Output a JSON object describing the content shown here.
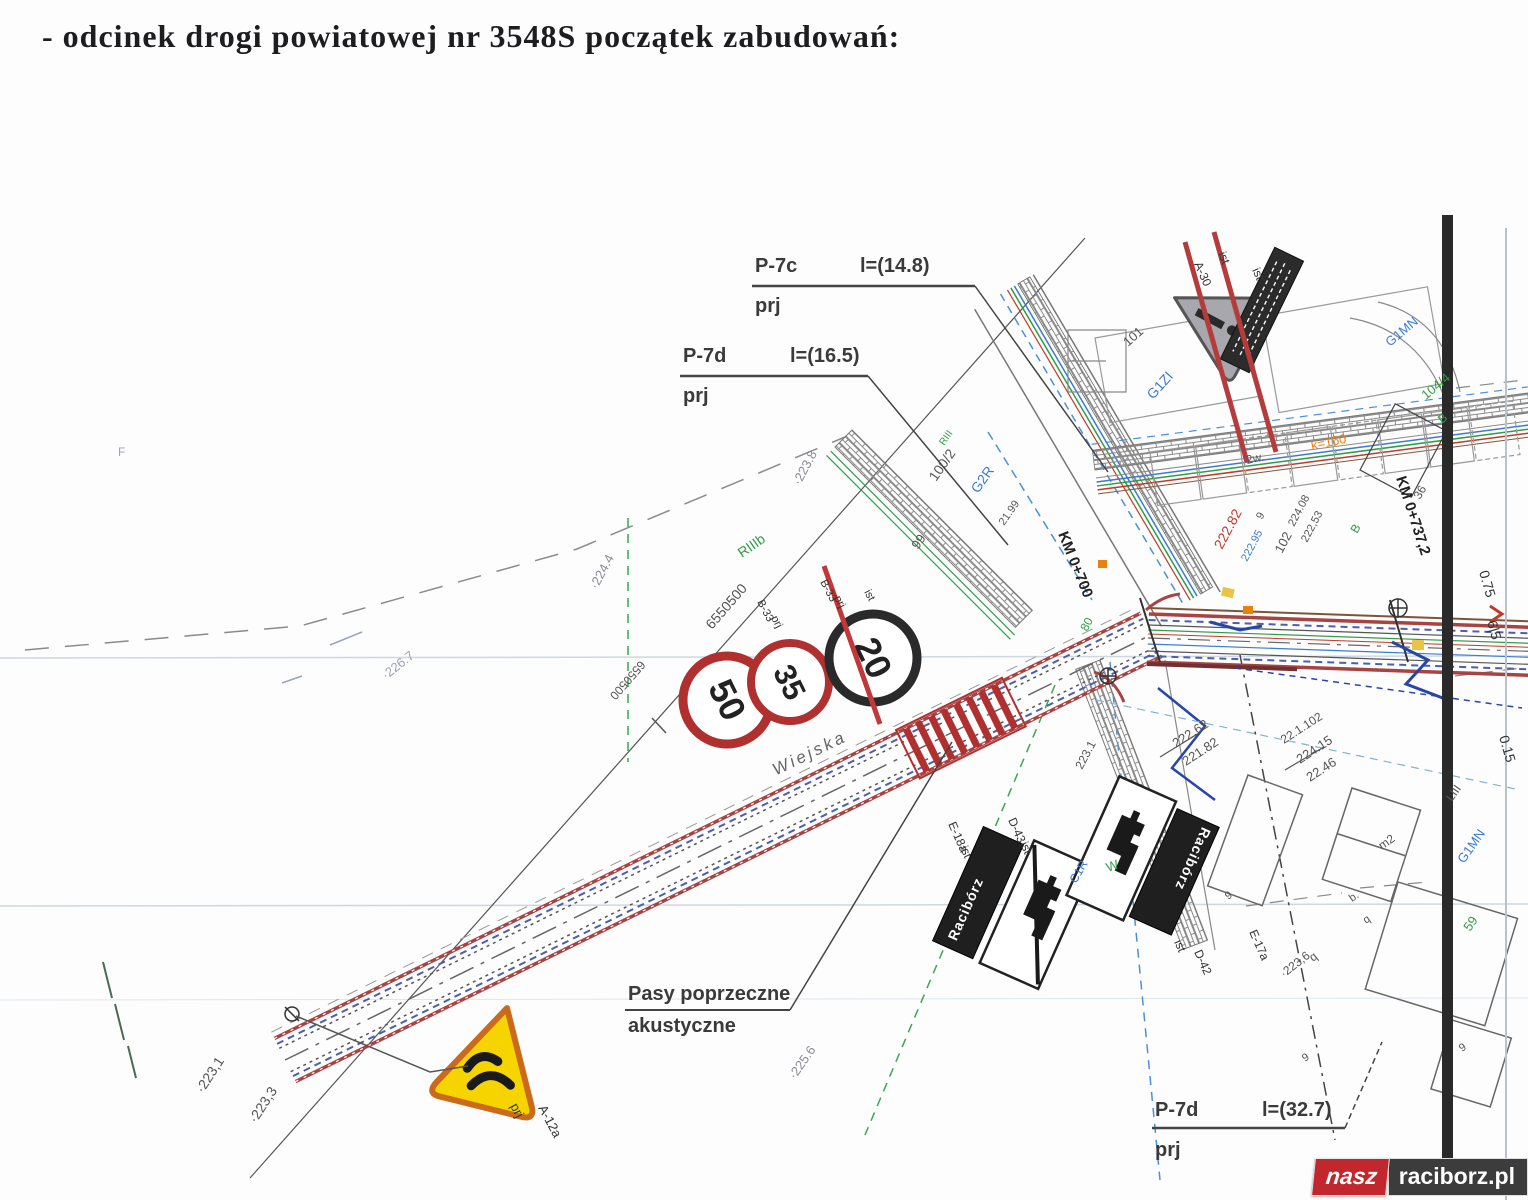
{
  "page": {
    "heading": "- odcinek drogi powiatowej nr 3548S początek zabudowań:"
  },
  "callouts": {
    "p7c": {
      "code": "P-7c",
      "length": "l=(14.8)",
      "status": "prj"
    },
    "p7d_top": {
      "code": "P-7d",
      "length": "l=(16.5)",
      "status": "prj"
    },
    "p7d_bottom": {
      "code": "P-7d",
      "length": "l=(32.7)",
      "status": "prj"
    },
    "acoustic": {
      "line1": "Pasy poprzeczne",
      "line2": "akustyczne"
    }
  },
  "signs": {
    "speed50": {
      "value": "50"
    },
    "speed35": {
      "value": "35"
    },
    "speed20": {
      "value": "20"
    },
    "town_name_left": "Racibórz",
    "town_name_right": "Racibórz"
  },
  "map": {
    "street_name": "Wiejska",
    "labels": [
      {
        "t": "·223.8",
        "x": 800,
        "y": 486,
        "r": -62,
        "c": "#8b8b95",
        "s": 13
      },
      {
        "t": "·224.4",
        "x": 597,
        "y": 590,
        "r": -62,
        "c": "#8b8b95",
        "s": 13
      },
      {
        "t": "·226.7",
        "x": 386,
        "y": 680,
        "r": -38,
        "c": "#9aa4b5",
        "s": 13
      },
      {
        "t": "·225.6",
        "x": 795,
        "y": 1080,
        "r": -55,
        "c": "#8b8b95",
        "s": 13
      },
      {
        "t": "·223,1",
        "x": 203,
        "y": 1094,
        "r": -57,
        "c": "#555555",
        "s": 14
      },
      {
        "t": "·223,3",
        "x": 256,
        "y": 1124,
        "r": -57,
        "c": "#555555",
        "s": 14
      },
      {
        "t": "6550500",
        "x": 712,
        "y": 630,
        "r": -49,
        "c": "#555555",
        "s": 14
      },
      {
        "t": "6550500",
        "x": 640,
        "y": 660,
        "r": 131,
        "c": "#555555",
        "s": 12
      },
      {
        "t": "RIIIb",
        "x": 742,
        "y": 558,
        "r": -35,
        "c": "#2f9e44",
        "s": 14
      },
      {
        "t": "RIII",
        "x": 944,
        "y": 446,
        "r": -55,
        "c": "#2f9e44",
        "s": 10
      },
      {
        "t": "100/2",
        "x": 936,
        "y": 482,
        "r": -55,
        "c": "#555555",
        "s": 14
      },
      {
        "t": "G2R",
        "x": 978,
        "y": 494,
        "r": -55,
        "c": "#3a7bd5",
        "s": 14
      },
      {
        "t": "21.99",
        "x": 1004,
        "y": 526,
        "r": -55,
        "c": "#555555",
        "s": 11
      },
      {
        "t": "99",
        "x": 918,
        "y": 550,
        "r": -55,
        "c": "#555555",
        "s": 13
      },
      {
        "t": "KM 0+700",
        "x": 1058,
        "y": 534,
        "r": 68,
        "c": "#222222",
        "s": 15,
        "b": 1
      },
      {
        "t": "KM 0+737,2",
        "x": 1396,
        "y": 478,
        "r": 72,
        "c": "#222222",
        "s": 15,
        "b": 1
      },
      {
        "t": "101",
        "x": 1128,
        "y": 347,
        "r": -42,
        "c": "#555555",
        "s": 13
      },
      {
        "t": "G1ZI",
        "x": 1153,
        "y": 400,
        "r": -48,
        "c": "#3a7bd5",
        "s": 14
      },
      {
        "t": "G1MN",
        "x": 1390,
        "y": 347,
        "r": -40,
        "c": "#3a7bd5",
        "s": 13
      },
      {
        "t": "104/4",
        "x": 1426,
        "y": 400,
        "r": -40,
        "c": "#2f9e44",
        "s": 13
      },
      {
        "t": "B",
        "x": 1442,
        "y": 424,
        "r": -40,
        "c": "#2f9e44",
        "s": 12
      },
      {
        "t": "B",
        "x": 1357,
        "y": 534,
        "r": -60,
        "c": "#2f9e44",
        "s": 12
      },
      {
        "t": "36",
        "x": 1420,
        "y": 500,
        "r": -60,
        "c": "#555555",
        "s": 12
      },
      {
        "t": "222.82",
        "x": 1222,
        "y": 550,
        "r": -62,
        "c": "#c0392b",
        "s": 14
      },
      {
        "t": "224.08",
        "x": 1294,
        "y": 527,
        "r": -62,
        "c": "#555555",
        "s": 11
      },
      {
        "t": "222,53",
        "x": 1307,
        "y": 543,
        "r": -62,
        "c": "#555555",
        "s": 11
      },
      {
        "t": "102",
        "x": 1282,
        "y": 554,
        "r": -62,
        "c": "#555555",
        "s": 13
      },
      {
        "t": "222.95",
        "x": 1247,
        "y": 562,
        "r": -62,
        "c": "#3a7bd5",
        "s": 11
      },
      {
        "t": "9",
        "x": 1262,
        "y": 520,
        "r": -62,
        "c": "#555555",
        "s": 11
      },
      {
        "t": "222.62",
        "x": 1176,
        "y": 748,
        "r": -33,
        "c": "#555555",
        "s": 13
      },
      {
        "t": "221.82",
        "x": 1186,
        "y": 766,
        "r": -33,
        "c": "#555555",
        "s": 13
      },
      {
        "t": "22.1.102",
        "x": 1284,
        "y": 744,
        "r": -33,
        "c": "#555555",
        "s": 12
      },
      {
        "t": "224.15",
        "x": 1300,
        "y": 764,
        "r": -33,
        "c": "#555555",
        "s": 13
      },
      {
        "t": "22.46",
        "x": 1310,
        "y": 782,
        "r": -33,
        "c": "#555555",
        "s": 13
      },
      {
        "t": "223.1",
        "x": 1082,
        "y": 770,
        "r": -62,
        "c": "#555555",
        "s": 12
      },
      {
        "t": "·223,6",
        "x": 1284,
        "y": 978,
        "r": -38,
        "c": "#555555",
        "s": 12
      },
      {
        "t": "q",
        "x": 1313,
        "y": 962,
        "r": -38,
        "c": "#555555",
        "s": 12
      },
      {
        "t": "b.",
        "x": 1352,
        "y": 902,
        "r": -35,
        "c": "#555555",
        "s": 11
      },
      {
        "t": "q",
        "x": 1366,
        "y": 924,
        "r": -35,
        "c": "#555555",
        "s": 11
      },
      {
        "t": "9",
        "x": 1228,
        "y": 900,
        "r": -35,
        "c": "#555555",
        "s": 11
      },
      {
        "t": "9",
        "x": 1305,
        "y": 1062,
        "r": -35,
        "c": "#555555",
        "s": 11
      },
      {
        "t": "9",
        "x": 1462,
        "y": 1052,
        "r": -35,
        "c": "#555555",
        "s": 11
      },
      {
        "t": "m2",
        "x": 1382,
        "y": 850,
        "r": -35,
        "c": "#555555",
        "s": 12
      },
      {
        "t": "2w.",
        "x": 1247,
        "y": 464,
        "r": -12,
        "c": "#555555",
        "s": 12
      },
      {
        "t": "k=160",
        "x": 1312,
        "y": 450,
        "r": -12,
        "c": "#e8820c",
        "s": 13
      },
      {
        "t": "0.75",
        "x": 1479,
        "y": 572,
        "r": 74,
        "c": "#333333",
        "s": 14
      },
      {
        "t": "6|5",
        "x": 1487,
        "y": 622,
        "r": 74,
        "c": "#333333",
        "s": 14
      },
      {
        "t": "0.15",
        "x": 1499,
        "y": 737,
        "r": 74,
        "c": "#333333",
        "s": 14
      },
      {
        "t": "LIII",
        "x": 1452,
        "y": 802,
        "r": -55,
        "c": "#555555",
        "s": 12
      },
      {
        "t": "G1MN",
        "x": 1464,
        "y": 864,
        "r": -55,
        "c": "#3a7bd5",
        "s": 13
      },
      {
        "t": "59",
        "x": 1470,
        "y": 932,
        "r": -55,
        "c": "#2f9e44",
        "s": 13
      },
      {
        "t": "W",
        "x": 1108,
        "y": 872,
        "r": -20,
        "c": "#2f9e44",
        "s": 13
      },
      {
        "t": "C1R",
        "x": 1076,
        "y": 884,
        "r": -60,
        "c": "#3a7bd5",
        "s": 12
      },
      {
        "t": "80",
        "x": 1087,
        "y": 632,
        "r": -62,
        "c": "#2f9e44",
        "s": 12
      },
      {
        "t": "B-33",
        "x": 757,
        "y": 602,
        "r": 62,
        "c": "#333333",
        "s": 11
      },
      {
        "t": "prj",
        "x": 771,
        "y": 618,
        "r": 62,
        "c": "#333333",
        "s": 11
      },
      {
        "t": "B-33",
        "x": 820,
        "y": 582,
        "r": 62,
        "c": "#333333",
        "s": 11
      },
      {
        "t": "prj",
        "x": 834,
        "y": 598,
        "r": 62,
        "c": "#333333",
        "s": 11
      },
      {
        "t": "ist",
        "x": 864,
        "y": 592,
        "r": 62,
        "c": "#333333",
        "s": 11
      },
      {
        "t": "A-30",
        "x": 1194,
        "y": 264,
        "r": 66,
        "c": "#333333",
        "s": 12
      },
      {
        "t": "ist",
        "x": 1218,
        "y": 254,
        "r": 66,
        "c": "#333333",
        "s": 12
      },
      {
        "t": "ist",
        "x": 1252,
        "y": 270,
        "r": 66,
        "c": "#333333",
        "s": 12
      },
      {
        "t": "A-12a",
        "x": 538,
        "y": 1108,
        "r": 62,
        "c": "#333333",
        "s": 13
      },
      {
        "t": "prj",
        "x": 510,
        "y": 1106,
        "r": 62,
        "c": "#333333",
        "s": 13
      },
      {
        "t": "E-18a",
        "x": 948,
        "y": 824,
        "r": 66,
        "c": "#333333",
        "s": 12
      },
      {
        "t": "ist",
        "x": 960,
        "y": 848,
        "r": 66,
        "c": "#333333",
        "s": 12
      },
      {
        "t": "D-43",
        "x": 1008,
        "y": 820,
        "r": 66,
        "c": "#333333",
        "s": 12
      },
      {
        "t": "ist",
        "x": 1020,
        "y": 844,
        "r": 66,
        "c": "#333333",
        "s": 12
      },
      {
        "t": "E-17a",
        "x": 1249,
        "y": 932,
        "r": 66,
        "c": "#333333",
        "s": 12
      },
      {
        "t": "D-42",
        "x": 1194,
        "y": 952,
        "r": 66,
        "c": "#333333",
        "s": 12
      },
      {
        "t": "ist",
        "x": 1174,
        "y": 942,
        "r": 66,
        "c": "#333333",
        "s": 12
      },
      {
        "t": "F",
        "x": 118,
        "y": 456,
        "r": 0,
        "c": "#9aa4b5",
        "s": 12
      }
    ]
  },
  "watermark": {
    "part1": "nasz",
    "part2": "raciborz.pl"
  }
}
